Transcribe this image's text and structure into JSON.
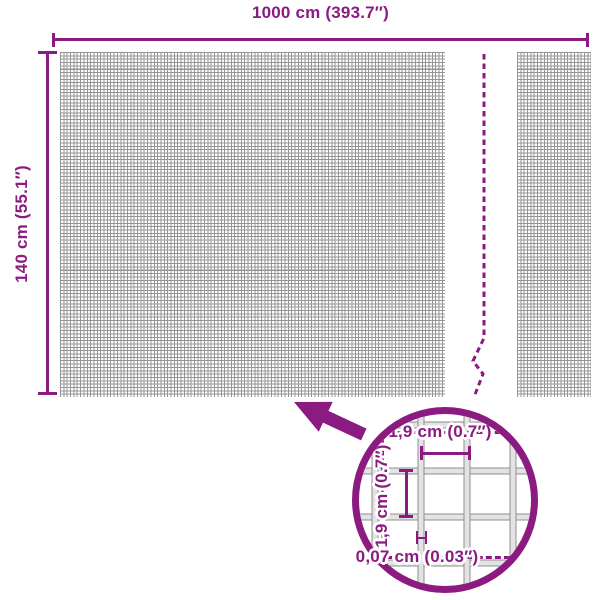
{
  "diagram": {
    "title_hint": "mesh product dimension diagram",
    "overall_width": {
      "label": "1000 cm (393.7″)"
    },
    "overall_height": {
      "label": "140 cm (55.1″)"
    },
    "detail": {
      "mesh_opening_width": "1,9 cm (0.7″)",
      "mesh_opening_height": "1,9 cm (0.7″)",
      "wire_thickness": "0,07 cm (0.03″)"
    },
    "colors": {
      "accent": "#8B1B80",
      "grid_line": "#949494",
      "zoom_bar_fill": "#E3E3E3",
      "zoom_bar_edge": "#8F8F8F",
      "background": "#FFFFFF"
    }
  }
}
